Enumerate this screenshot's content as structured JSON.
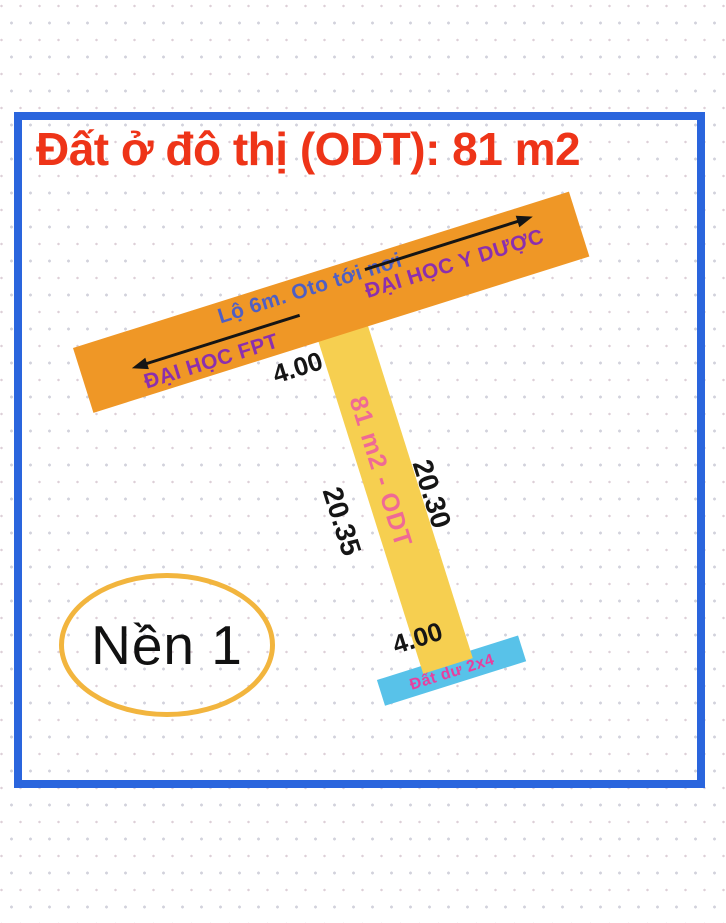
{
  "title": {
    "text": "Đất ở đô thị (ODT): 81 m2",
    "color": "#ee3418"
  },
  "road": {
    "label": "Lộ 6m. Oto tới nơi",
    "left_destination": "ĐẠI HỌC FPT",
    "right_destination": "ĐẠI HỌC Y DƯỢC",
    "color": "#ef9726",
    "label_color": "#4f5fc4",
    "destination_color": "#8c2fae"
  },
  "plot": {
    "label": "81 m2 - ODT",
    "top_width": "4.00",
    "bottom_width": "4.00",
    "left_length": "20.35",
    "right_length": "20.30",
    "color": "#f6cf50",
    "label_color": "#ef6a95"
  },
  "extra_land": {
    "label": "Đất dư 2x4",
    "color": "#58c2e9",
    "label_color": "#e73f9e"
  },
  "badge": {
    "label": "Nền 1",
    "border_color": "#f2b53e"
  },
  "frame": {
    "border_color": "#2a65dd"
  }
}
